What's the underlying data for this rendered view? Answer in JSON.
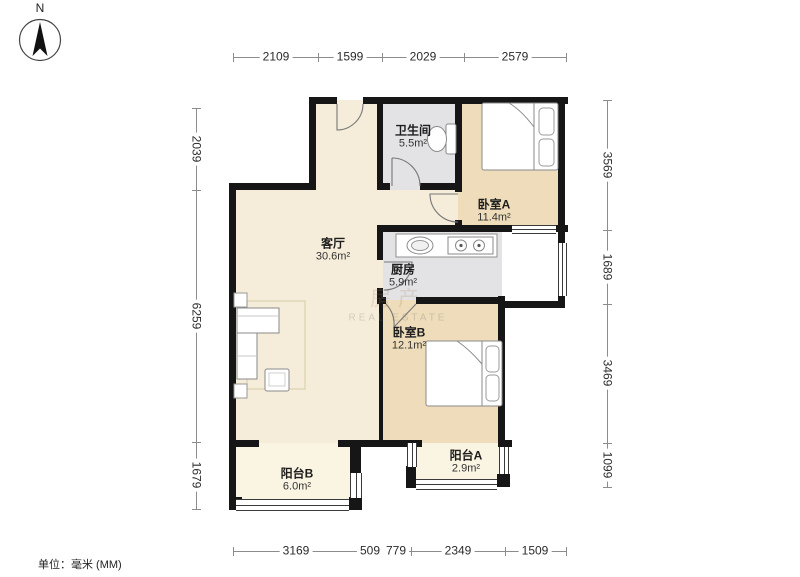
{
  "note": {
    "units": "单位：毫米 (MM)"
  },
  "compass": {
    "label": "N"
  },
  "rooms": [
    {
      "name": "客厅",
      "area": "30.6m²"
    },
    {
      "name": "卫生间",
      "area": "5.5m²"
    },
    {
      "name": "卧室A",
      "area": "11.4m²"
    },
    {
      "name": "厨房",
      "area": "5.9m²"
    },
    {
      "name": "卧室B",
      "area": "12.1m²"
    },
    {
      "name": "阳台B",
      "area": "6.0m²"
    },
    {
      "name": "阳台A",
      "area": "2.9m²"
    }
  ],
  "dimensions_mm": {
    "top": [
      "2109",
      "1599",
      "2029",
      "2579"
    ],
    "left": [
      "2039",
      "6259",
      "1679"
    ],
    "right": [
      "3569",
      "1689",
      "3469",
      "1099"
    ],
    "bottom": [
      "3169",
      "509",
      "779",
      "2349",
      "1509"
    ]
  },
  "watermark": {
    "line1": "房产",
    "line2": "REAL ESTATE"
  },
  "colors": {
    "wall": "#161616",
    "living_floor": "#f5edda",
    "bedroom_floor": "#eedcba",
    "wet_floor": "#e3e3e6",
    "balcony_floor": "#faf4e2"
  }
}
